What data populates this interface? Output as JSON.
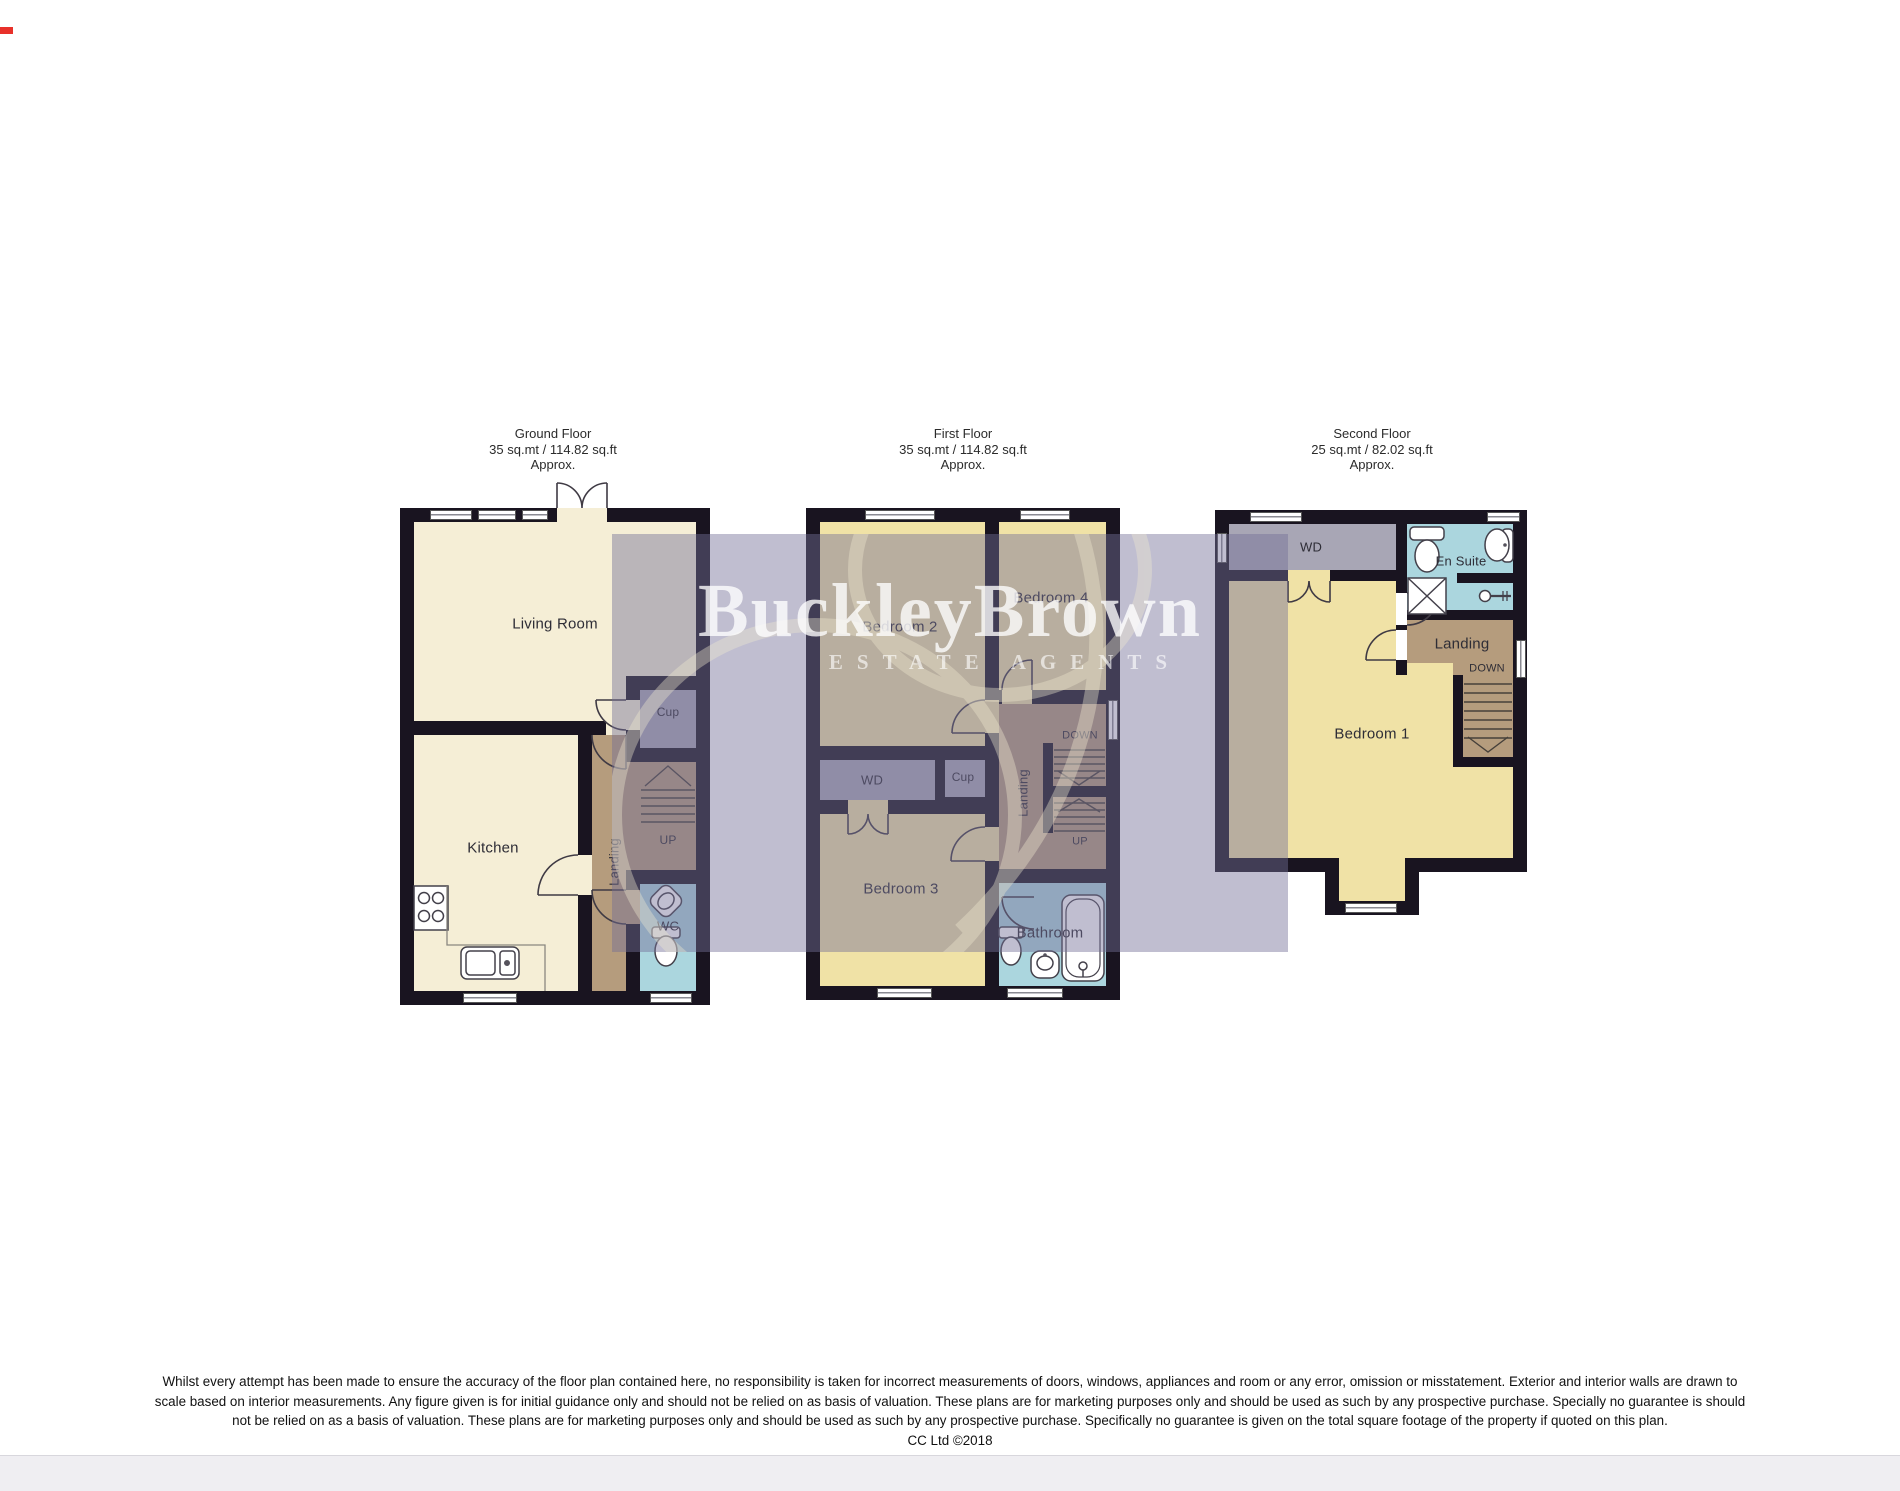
{
  "brand": {
    "name": "BuckleyBrown",
    "tagline": "ESTATE AGENTS"
  },
  "floors": {
    "ground": {
      "title": "Ground Floor",
      "area": "35 sq.mt / 114.82 sq.ft",
      "approx": "Approx.",
      "labels": {
        "living_room": "Living Room",
        "kitchen": "Kitchen",
        "landing": "Landing",
        "cup": "Cup",
        "wc": "WC",
        "up": "UP"
      }
    },
    "first": {
      "title": "First Floor",
      "area": "35 sq.mt / 114.82 sq.ft",
      "approx": "Approx.",
      "labels": {
        "bedroom2": "Bedroom 2",
        "bedroom4": "Bedroom 4",
        "wd": "WD",
        "cup": "Cup",
        "landing": "Landing",
        "bedroom3": "Bedroom 3",
        "bathroom": "Bathroom",
        "down": "DOWN",
        "up": "UP"
      }
    },
    "second": {
      "title": "Second Floor",
      "area": "25 sq.mt / 82.02 sq.ft",
      "approx": "Approx.",
      "labels": {
        "wd": "WD",
        "en_suite": "En Suite",
        "landing": "Landing",
        "down": "DOWN",
        "bedroom1": "Bedroom 1"
      }
    }
  },
  "disclaimer": {
    "line1": "Whilst every attempt has been made to ensure the accuracy of the floor plan contained here, no responsibility is taken for incorrect measurements of doors, windows, appliances and room or any error, omission or misstatement. Exterior and interior walls are drawn to",
    "line2": "scale based on interior measurements. Any figure given is for initial guidance only and should not be relied on as basis of valuation. These plans are for marketing purposes only and should be used as such by any prospective purchase. Specially no guarantee is should",
    "line3": "not be relied on as a basis of valuation. These plans are for marketing purposes only and should be used as such by any prospective purchase. Specifically no guarantee is given on the total square footage of the property if quoted on this plan.",
    "line4": "CC Ltd ©2018"
  },
  "colors": {
    "cream": "#f5eed6",
    "bedroom": "#f0e2a6",
    "landing_brown": "#b59c7d",
    "store_gray": "#a8a6b5",
    "bath_blue": "#abd6de",
    "wall": "#191420",
    "overlay": "#746e96",
    "swirl": "#f0ead0"
  }
}
